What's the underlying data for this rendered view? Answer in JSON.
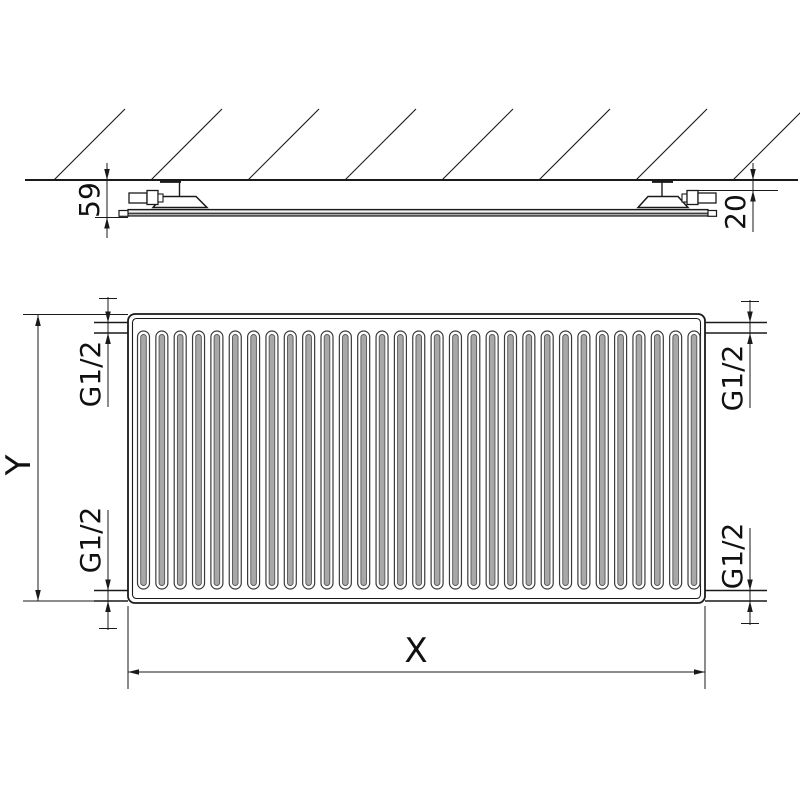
{
  "side_view": {
    "depth_dim": "59",
    "wall_gap_dim": "20",
    "hatch_line_count": 8
  },
  "front_view": {
    "height_dim": "Y",
    "width_dim": "X",
    "conn_top_left": "G1/2",
    "conn_top_right": "G1/2",
    "conn_bottom_left": "G1/2",
    "conn_bottom_right": "G1/2",
    "corrugation_count": 31
  },
  "colors": {
    "line": "#1a1a1a",
    "channel_outline": "#3a3a3a",
    "channel_shade": "#a8a8a8",
    "background": "#ffffff"
  }
}
